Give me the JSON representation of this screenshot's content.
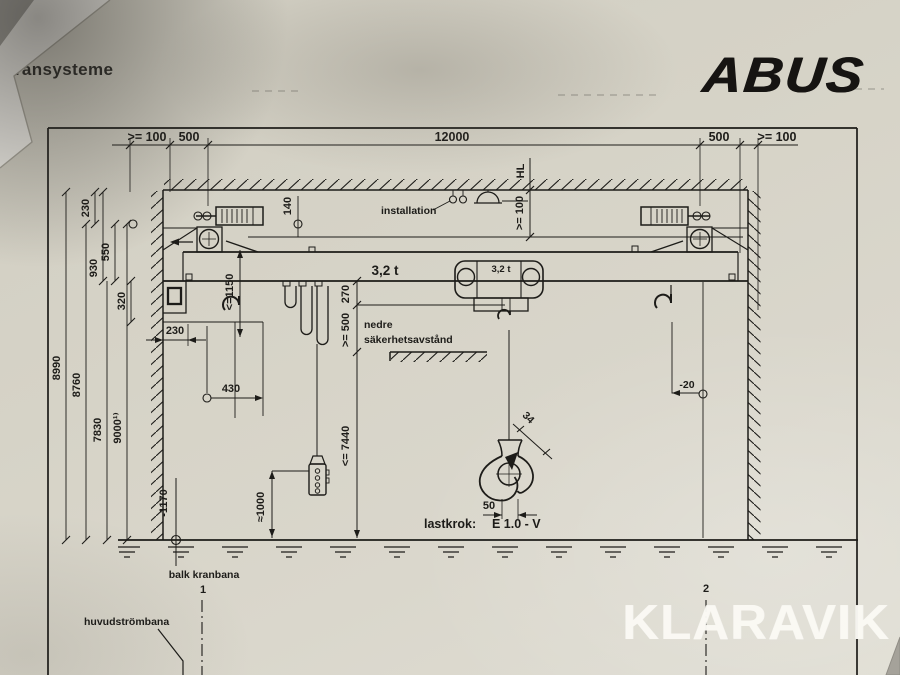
{
  "photo": {
    "sheet_title": "kransysteme",
    "brand": "ABUS",
    "watermark": "KLARAVIK"
  },
  "drawing": {
    "top_dims": {
      "left_edge": ">= 100",
      "left_rail": "500",
      "span": "12000",
      "right_rail": "500",
      "right_edge": ">= 100"
    },
    "left_dims": {
      "d230a": "230",
      "d550": "550",
      "d930": "930",
      "d320": "320",
      "d8990": "8990",
      "d8760": "8760",
      "d7830": "7830",
      "d9000": "9000¹⁾",
      "d230b": "230",
      "d430": "430",
      "dminus1170": "-1170"
    },
    "center": {
      "hl": "HL",
      "headroom_100": ">= 100",
      "installation": "installation",
      "d140": "140",
      "d1150": "<=1150",
      "capacity_beam": "3,2 t",
      "capacity_hoist": "3,2 t",
      "d270": "270",
      "d500": ">= 500",
      "nedre_line1": "nedre",
      "nedre_line2": "säkerhetsavstånd",
      "d7440": "<= 7440",
      "d1000": "≈1000",
      "dminus20": "-20"
    },
    "hook_detail": {
      "d34": "34",
      "d50": "50",
      "label": "lastkrok:",
      "value": "E 1.0 - V"
    },
    "footer": {
      "runway_label": "balk kranbana",
      "axis1": "1",
      "axis2": "2",
      "busbar_label": "huvudströmbana"
    }
  }
}
